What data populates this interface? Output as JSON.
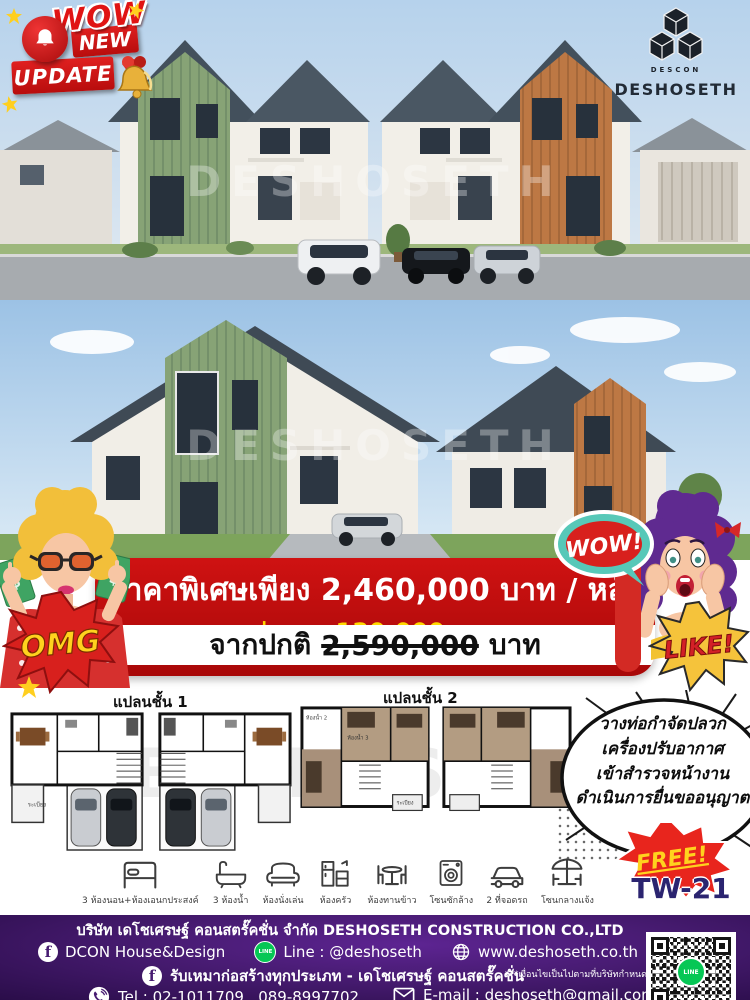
{
  "badges": {
    "wow": "WOW",
    "new_label": "NEW",
    "update_label": "UPDATE"
  },
  "brand": {
    "logo_text": "DESHOSETH",
    "logo_small": "DESCON"
  },
  "watermark": {
    "text": "DESHOSETH"
  },
  "price_banner": {
    "line1": "ราคาพิเศษเพียง  2,460,000  บาท / หลัง",
    "discount_line": "ส่วนลด  130,000  บาท",
    "original_prefix": "จากปกติ",
    "original_price": "2,590,000",
    "original_suffix": "บาท"
  },
  "comic": {
    "omg": "OMG",
    "wow_bubble": "WOW!",
    "like": "LIKE!",
    "money_symbol": "$"
  },
  "floorplans": {
    "plan1_label": "แปลนชั้น 1",
    "plan2_label": "แปลนชั้น 2",
    "plan1_rooms": [
      "ระเบียง"
    ],
    "plan2_rooms": [
      "ห้องน้ำ 2",
      "ห้องน้ำ 3",
      "ระเบียง"
    ]
  },
  "callout": {
    "line1": "วางท่อกำจัดปลวก",
    "line2": "เครื่องปรับอากาศ",
    "line3": "เข้าสำรวจหน้างาน",
    "line4": "ดำเนินการยื่นขออนุญาต",
    "free_label": "FREE!",
    "model_code": "TW-21"
  },
  "amenities": [
    {
      "icon": "bed-icon",
      "label": "3 ห้องนอน+ห้องเอนกประสงค์"
    },
    {
      "icon": "bathtub-icon",
      "label": "3 ห้องน้ำ"
    },
    {
      "icon": "armchair-icon",
      "label": "ห้องนั่งเล่น"
    },
    {
      "icon": "kitchen-icon",
      "label": "ห้องครัว"
    },
    {
      "icon": "dining-icon",
      "label": "ห้องทานข้าว"
    },
    {
      "icon": "washer-icon",
      "label": "โซนซักล้าง"
    },
    {
      "icon": "car-icon",
      "label": "2 ที่จอดรถ"
    },
    {
      "icon": "outdoor-icon",
      "label": "โซนกลางแจ้ง"
    }
  ],
  "footer": {
    "company": "บริษัท เดโชเศรษฐ์ คอนสตรั๊คชั่น จำกัด DESHOSETH CONSTRUCTION CO.,LTD",
    "facebook": "DCON House&Design",
    "line": "Line : @deshoseth",
    "website": "www.deshoseth.co.th",
    "facebook2": "รับเหมาก่อสร้างทุกประเภท - เดโชเศรษฐ์ คอนสตรั๊คชั่น",
    "disclaimer": "***เงื่อนไขเป็นไปตามที่บริษัทกำหนด",
    "tel": "Tel : 02-1011709 , 089-8997702",
    "email": "E-mail : deshoseth@gmail.com",
    "fb_glyph": "f",
    "line_glyph": "LINE",
    "qr_center_label": "LINE"
  },
  "colors": {
    "banner_red": "#bf0b10",
    "discount_yellow": "#ffd900",
    "footer_purple": "#471b71",
    "green_house": "#87a376",
    "orange_house": "#bd7844",
    "roof_dark": "#43505c",
    "model_navy": "#2b2470",
    "line_green": "#06c755",
    "free_red": "#e8251d"
  }
}
